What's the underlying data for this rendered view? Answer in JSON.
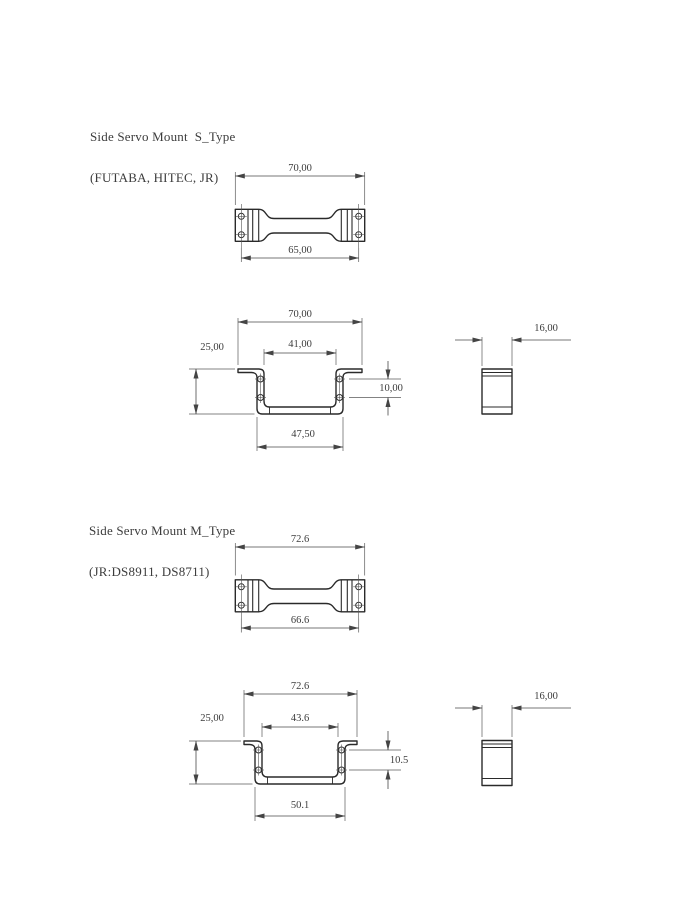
{
  "colors": {
    "part_line": "#2a2a2a",
    "dim_line": "#4a4a4a",
    "text": "#3c3c3c",
    "background": "#ffffff"
  },
  "sections": [
    {
      "title_line1": "Side Servo Mount  S_Type",
      "title_line2": "(FUTABA, HITEC, JR)",
      "top_view": {
        "dim_overall": "70,00",
        "dim_holes": "65,00"
      },
      "front_view": {
        "dim_overall": "70,00",
        "dim_inner": "41,00",
        "dim_height": "25,00",
        "dim_hole_spacing": "10,00",
        "dim_outer": "47,50"
      },
      "side_view": {
        "dim_depth": "16,00"
      }
    },
    {
      "title_line1": "Side Servo Mount M_Type",
      "title_line2": "(JR:DS8911, DS8711)",
      "top_view": {
        "dim_overall": "72.6",
        "dim_holes": "66.6"
      },
      "front_view": {
        "dim_overall": "72.6",
        "dim_inner": "43.6",
        "dim_height": "25,00",
        "dim_hole_spacing": "10.5",
        "dim_outer": "50.1"
      },
      "side_view": {
        "dim_depth": "16,00"
      }
    }
  ]
}
